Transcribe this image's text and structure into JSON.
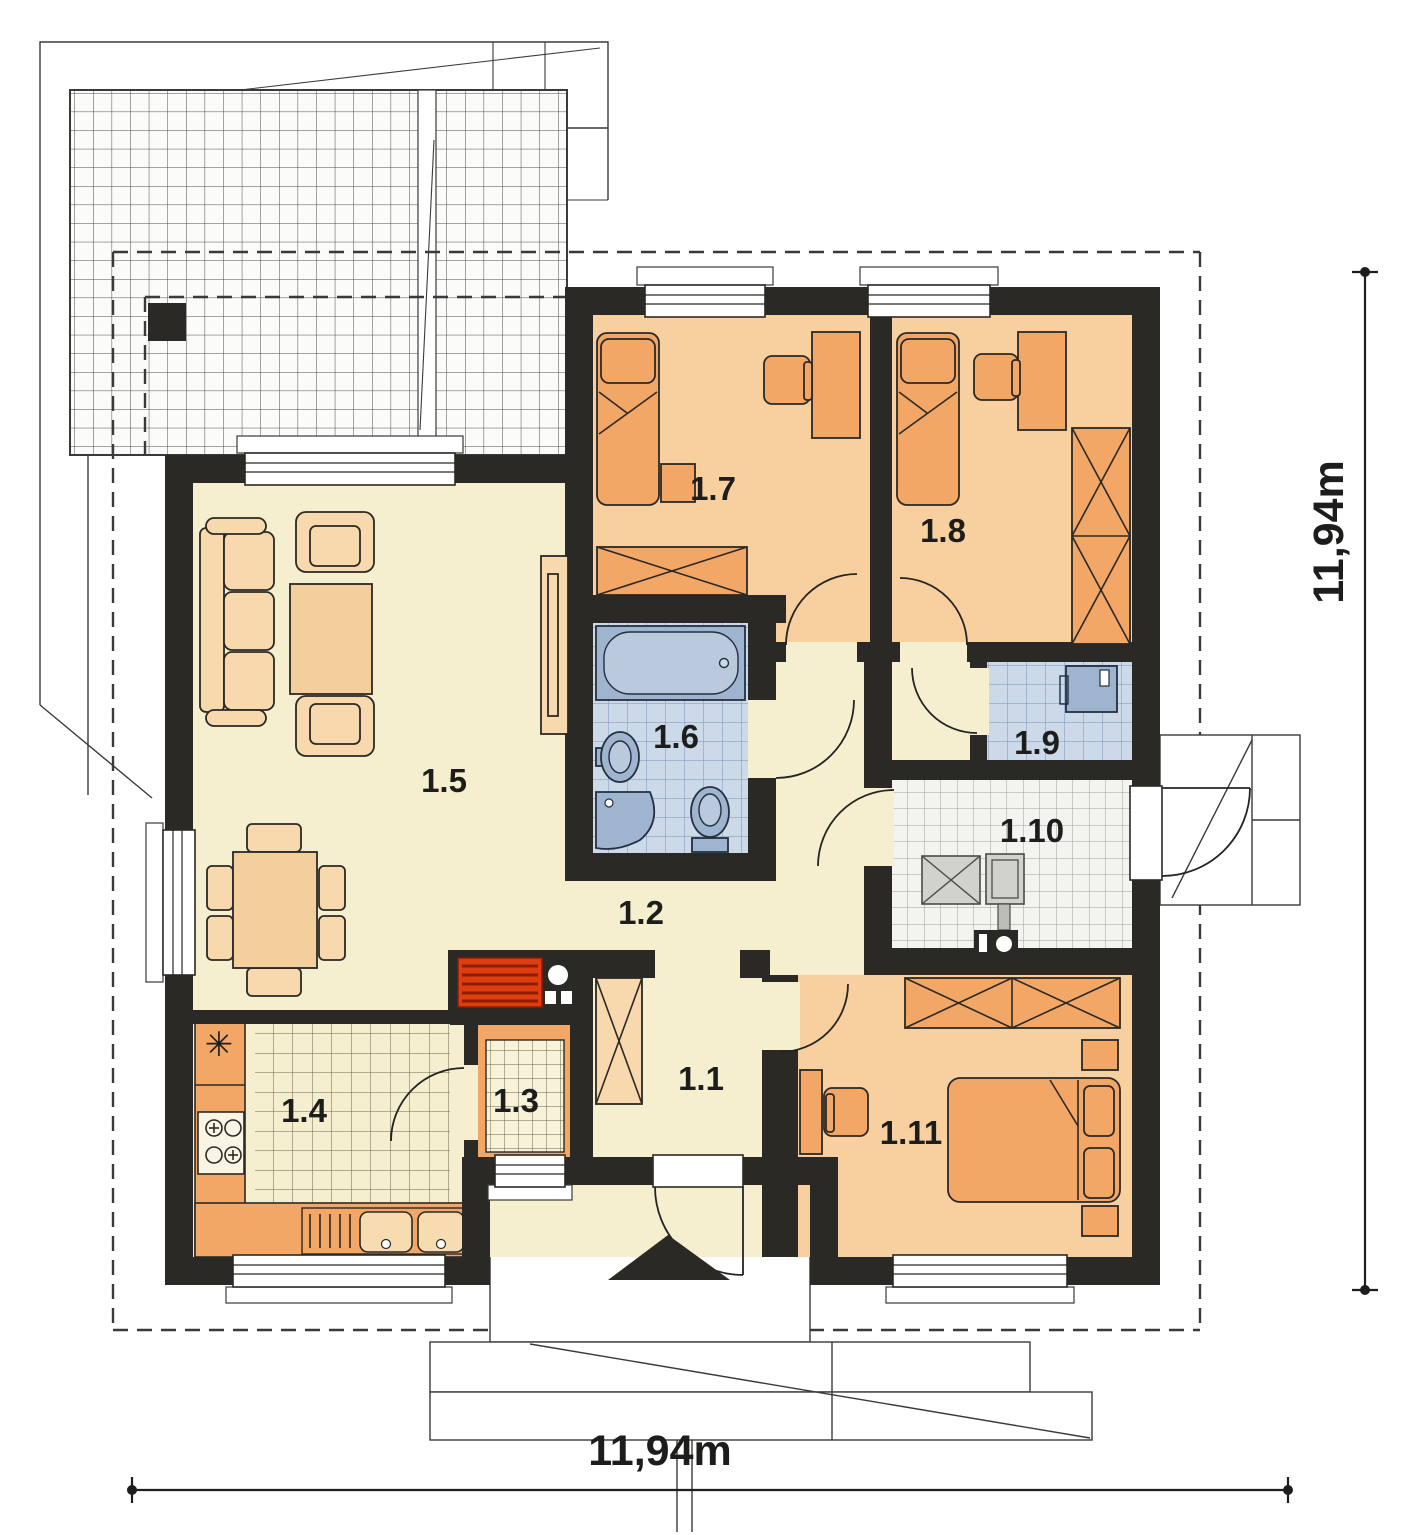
{
  "plan": {
    "type": "single-storey house floor plan",
    "dimensions": {
      "bottom": "11,94m",
      "right": "11,94m"
    },
    "rooms": [
      {
        "id": "1.1",
        "label": "1.1",
        "name": "entry-hall"
      },
      {
        "id": "1.2",
        "label": "1.2",
        "name": "corridor"
      },
      {
        "id": "1.3",
        "label": "1.3",
        "name": "pantry"
      },
      {
        "id": "1.4",
        "label": "1.4",
        "name": "kitchen"
      },
      {
        "id": "1.5",
        "label": "1.5",
        "name": "living-room"
      },
      {
        "id": "1.6",
        "label": "1.6",
        "name": "bathroom"
      },
      {
        "id": "1.7",
        "label": "1.7",
        "name": "bedroom-1"
      },
      {
        "id": "1.8",
        "label": "1.8",
        "name": "bedroom-2"
      },
      {
        "id": "1.9",
        "label": "1.9",
        "name": "wc"
      },
      {
        "id": "1.10",
        "label": "1.10",
        "name": "utility-room"
      },
      {
        "id": "1.11",
        "label": "1.11",
        "name": "bedroom-3"
      }
    ],
    "symbols": {
      "fridge": "✳"
    },
    "colors": {
      "wall": "#2b2925",
      "floor_main": "#f6efcf",
      "floor_bedroom": "#f8cf9f",
      "furniture_orange": "#f2a766",
      "furniture_light": "#f7d9ad",
      "bath_tile": "#ccd9e9",
      "bath_fixture": "#9fb4cf",
      "utility_tile": "#f3f3f0",
      "fireplace_red": "#e03c12",
      "outline": "#3a3a38"
    }
  }
}
